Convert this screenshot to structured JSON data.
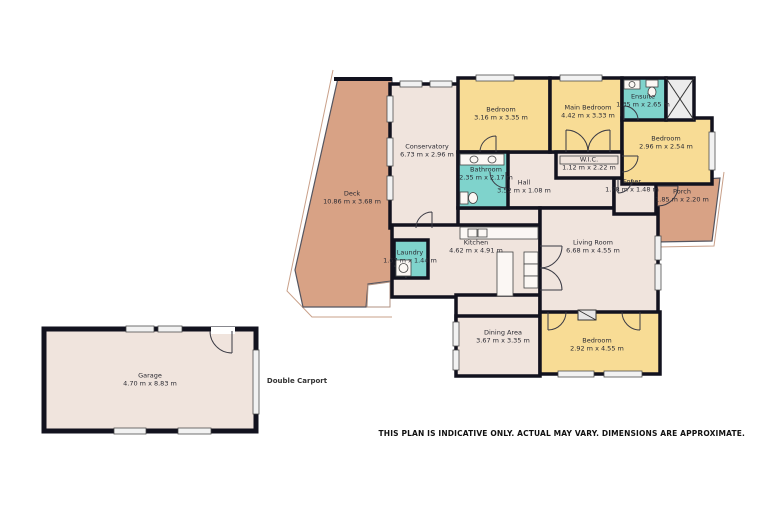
{
  "rooms": [
    {
      "id": "deck",
      "name": "Deck",
      "dims": "10.86 m x 3.68 m"
    },
    {
      "id": "conservatory",
      "name": "Conservatory",
      "dims": "6.73 m x 2.96 m"
    },
    {
      "id": "bedroom-top",
      "name": "Bedroom",
      "dims": "3.16 m x 3.35 m"
    },
    {
      "id": "main-bedroom",
      "name": "Main Bedroom",
      "dims": "4.42 m x 3.33 m"
    },
    {
      "id": "ensuite",
      "name": "Ensuite",
      "dims": "1.35 m x 2.65 m"
    },
    {
      "id": "bedroom-right",
      "name": "Bedroom",
      "dims": "2.96 m x 2.54 m"
    },
    {
      "id": "wic",
      "name": "W.I.C.",
      "dims": "1.12 m x 2.22 m"
    },
    {
      "id": "bathroom",
      "name": "Bathroom",
      "dims": "2.35 m x 2.17 m"
    },
    {
      "id": "hall",
      "name": "Hall",
      "dims": "3.52 m x 1.08 m"
    },
    {
      "id": "foyer",
      "name": "Foyer",
      "dims": "1.78 m x 1.48 m"
    },
    {
      "id": "porch",
      "name": "Porch",
      "dims": "1.85 m x 2.20 m"
    },
    {
      "id": "kitchen",
      "name": "Kitchen",
      "dims": "4.62 m x 4.91 m"
    },
    {
      "id": "laundry",
      "name": "Laundry",
      "dims": "1.67 m x 1.44 m"
    },
    {
      "id": "living-room",
      "name": "Living Room",
      "dims": "6.68 m x 4.55 m"
    },
    {
      "id": "dining-area",
      "name": "Dining Area",
      "dims": "3.67 m x 3.35 m"
    },
    {
      "id": "bedroom-bottom",
      "name": "Bedroom",
      "dims": "2.92 m x 4.55 m"
    },
    {
      "id": "garage",
      "name": "Garage",
      "dims": "4.70 m x 8.83 m"
    }
  ],
  "annotations": {
    "double_carport": "Double Carport",
    "disclaimer": "THIS PLAN IS INDICATIVE ONLY. ACTUAL MAY VARY. DIMENSIONS ARE APPROXIMATE."
  },
  "colors": {
    "background": "#ffffff",
    "room_default": "#f0e4dd",
    "bedroom": "#f8dc95",
    "wet_area": "#7fd3cc",
    "deck_porch": "#d8a285",
    "walls": "#12121e",
    "text": "#2b2b33"
  }
}
